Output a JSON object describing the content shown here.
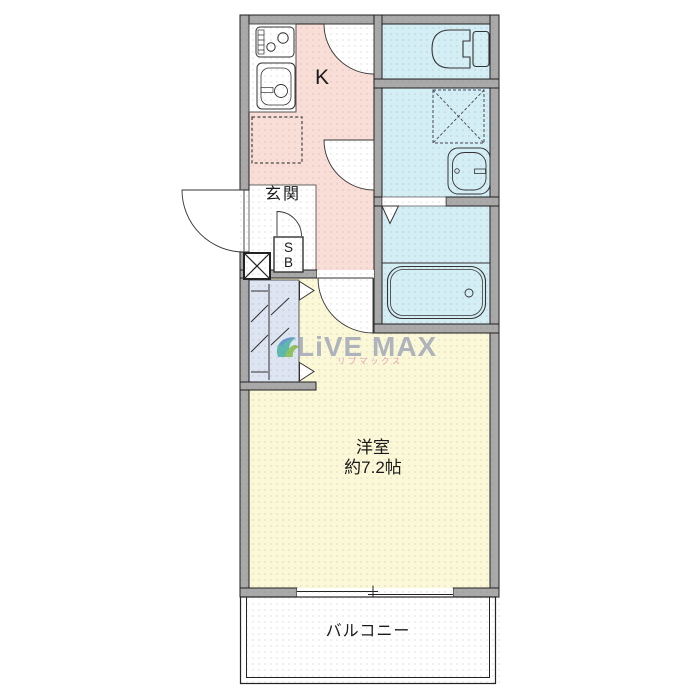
{
  "floorplan": {
    "rooms": {
      "kitchen": {
        "label": "K"
      },
      "entrance": {
        "label": "玄関"
      },
      "shoe_box": {
        "line1": "S",
        "line2": "B"
      },
      "western_room": {
        "name": "洋室",
        "size": "約7.2帖"
      },
      "balcony": {
        "label": "バルコニー"
      }
    },
    "watermark": {
      "brand": "LiVE MAX",
      "subtext": "リブマックス"
    },
    "colors": {
      "kitchen-floor": "#f8ded6",
      "wet-floor": "#d4eef6",
      "room-floor": "#fbf8d8",
      "closet-floor": "#dde4f2",
      "wall-fill": "#a9a9a9",
      "watermark-text": "#9da3b5",
      "watermark-subtext": "#e29cb2",
      "logo-teal": "#3fae9f",
      "logo-green": "#7cb93e",
      "logo-blue": "#4f86c9"
    }
  }
}
